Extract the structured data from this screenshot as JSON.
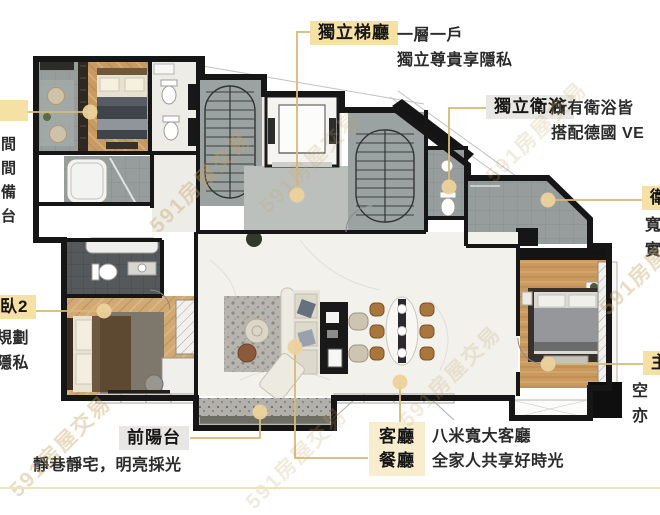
{
  "watermark": {
    "text": "591房屋交易"
  },
  "callouts": {
    "lobby": {
      "label": "獨立梯廳",
      "line1": "一層一戶",
      "line2": "獨立尊貴享隱私"
    },
    "bathrooms": {
      "label": "獨立衛浴",
      "line1": "所有衛浴皆",
      "line2": "搭配德國 VE"
    },
    "right_middle": {
      "label": "衛",
      "line1": "寬",
      "line2": "實"
    },
    "right_bottom": {
      "label": "主",
      "line1": "空",
      "line2": "亦"
    },
    "left_top": {
      "line1": "間",
      "line2": "間",
      "line3": "備",
      "line4": "台"
    },
    "left_middle": {
      "label": "臥2",
      "line1": "規劃",
      "line2": "隱私"
    },
    "front_balcony": {
      "label": "前陽台",
      "line1": "靜巷靜宅，明亮採光"
    },
    "living_dining": {
      "label_line1": "客廳",
      "label_line2": "餐廳",
      "line1": "八米寬大客廳",
      "line2": "全家人共享好時光"
    }
  },
  "colors": {
    "leader_line": "#d8b876",
    "leader_dot": "#ecd29b",
    "label_tan": "#f6e1a4",
    "label_cream": "#f8edcd",
    "label_gray": "#e9e7e3",
    "wall": "#161616"
  }
}
